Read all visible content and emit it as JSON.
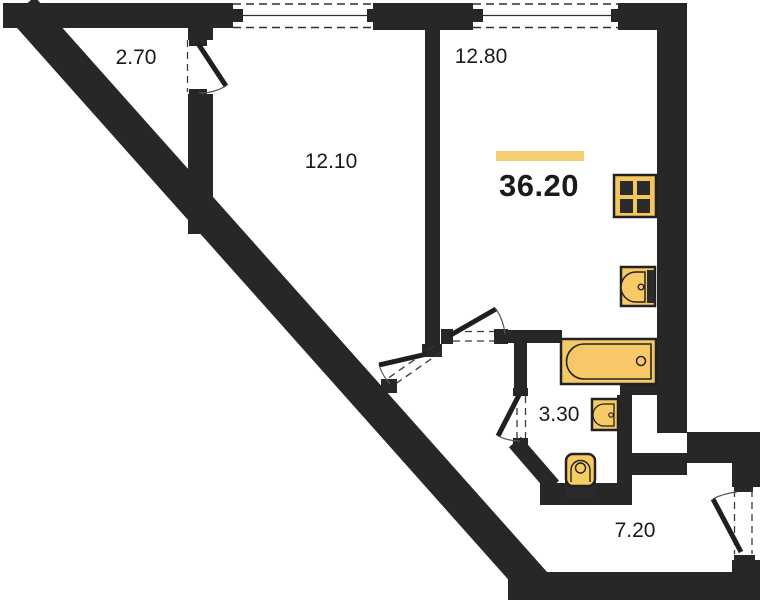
{
  "plan": {
    "total_area": "36.20",
    "rooms": [
      {
        "name": "balcony",
        "area": "2.70"
      },
      {
        "name": "bedroom",
        "area": "12.10"
      },
      {
        "name": "kitchen-living-room",
        "area": "12.80"
      },
      {
        "name": "bathroom",
        "area": "3.30"
      },
      {
        "name": "hallway",
        "area": "7.20"
      }
    ],
    "fixtures": [
      {
        "icon": "stove-icon"
      },
      {
        "icon": "kitchen-sink-icon"
      },
      {
        "icon": "bathtub-icon"
      },
      {
        "icon": "washbasin-icon"
      },
      {
        "icon": "toilet-icon"
      }
    ],
    "colors": {
      "wall": "#272727",
      "fixture_fill": "#f6c866",
      "fixture_stroke": "#222222",
      "highlight_bar": "#f7ce6f",
      "background": "#ffffff",
      "text": "#1a1a1a"
    }
  }
}
